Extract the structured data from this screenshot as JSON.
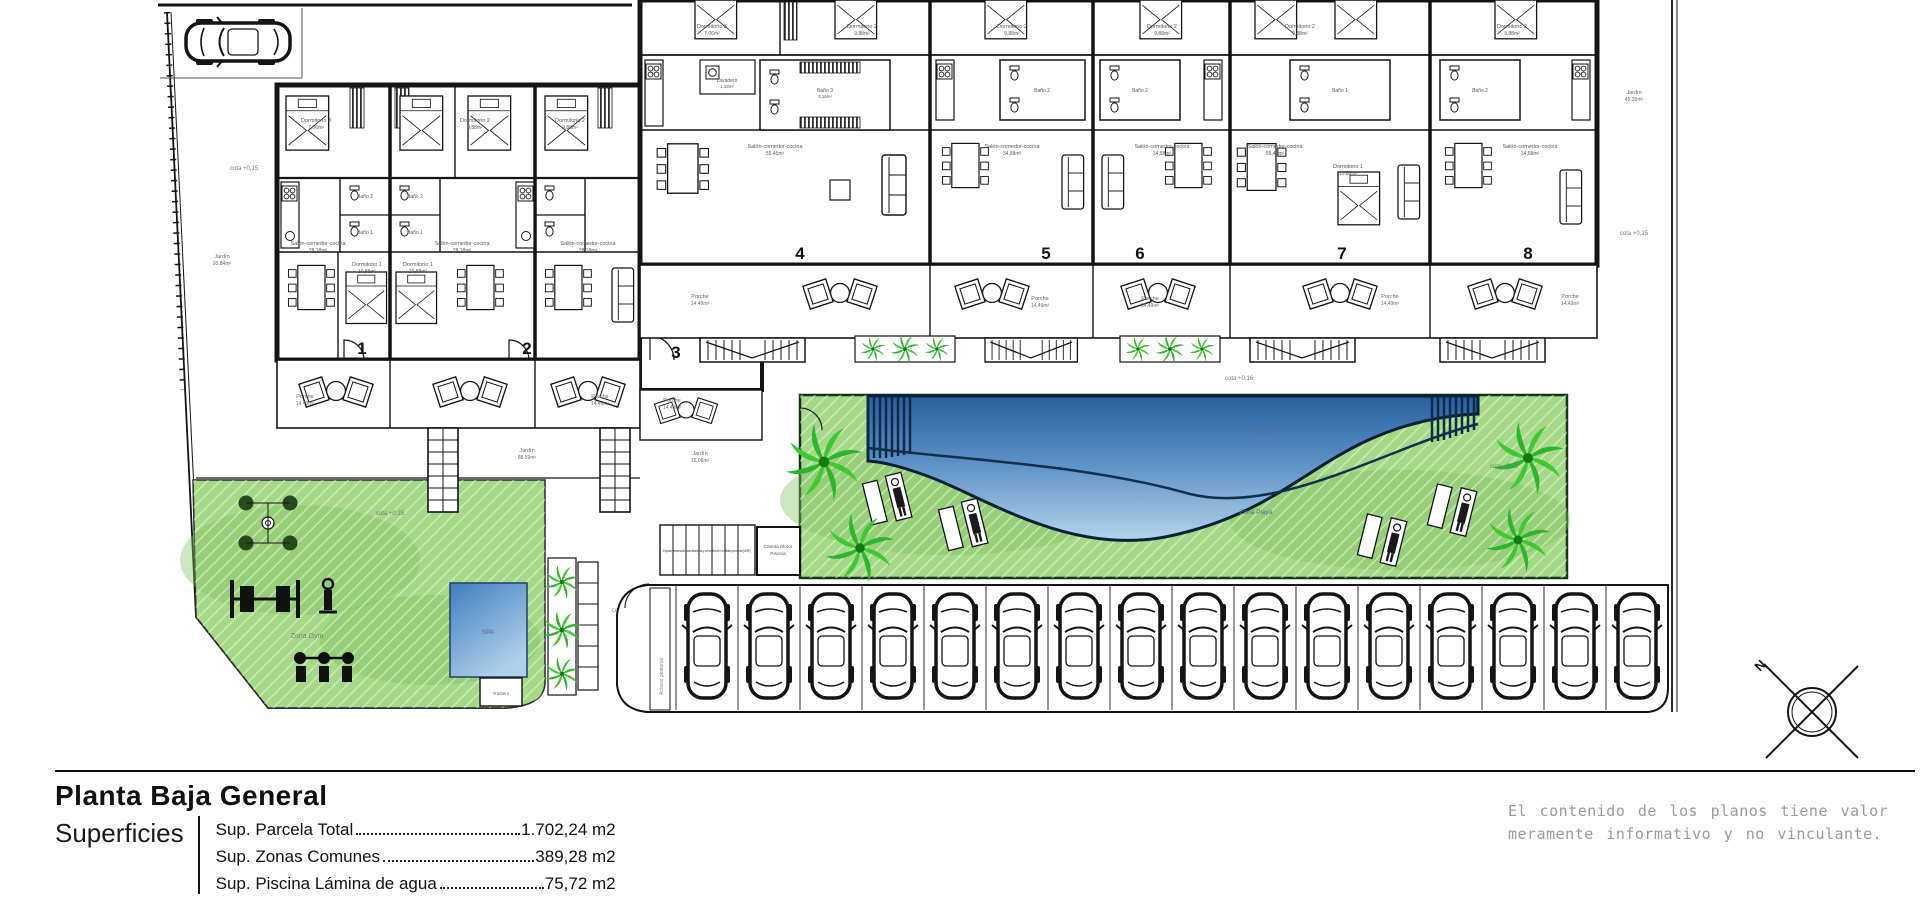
{
  "tb": {
    "title": "Planta Baja General",
    "sup_label": "Superficies",
    "rows": [
      {
        "label": "Sup. Parcela Total",
        "value": "1.702,24 m2"
      },
      {
        "label": "Sup. Zonas Comunes",
        "value": "389,28 m2"
      },
      {
        "label": "Sup. Piscina Lámina de agua",
        "value": "75,72 m2"
      }
    ],
    "disc": [
      "El contenido de los planos tiene valor",
      "meramente informativo y no vinculante."
    ]
  },
  "units": [
    "1",
    "2",
    "3",
    "4",
    "5",
    "6",
    "7",
    "8"
  ],
  "rooms": {
    "d1": "Dormitorio 1",
    "d1a": "10,88m²",
    "d2": "Dormitorio 2",
    "d2a": "9,88m²",
    "d3": "Dormitorio 3",
    "d3a": "7,06m²",
    "b1": "Baño 1",
    "b1a": "3,64m²",
    "b2": "Baño 2",
    "b2a": "3,76m²",
    "b3": "Baño 3",
    "b3a": "3,16m²",
    "salon": "Salón-comedor-cocina",
    "salon_a1": "28,18m²",
    "salon_a2": "55,45m²",
    "salon_a3": "34,58m²",
    "lav": "Lavadero",
    "lava": "1,43m²",
    "porche": "Porche",
    "porchea": "14,49m²",
    "jardin": "Jardín",
    "ja1": "93,84m²",
    "ja2": "88,59m²",
    "ja3": "15,06m²",
    "ja4": "45,26m²"
  },
  "site": {
    "cota15": "cota +0,15",
    "cota16": "cota +0,16",
    "piscina": "Piscina",
    "zona_playa": "Zona Playa",
    "zona_gym": "Zona Gym",
    "spa": "SPA",
    "caseta1": "Caseta Motor",
    "caseta2": "Piscina",
    "trastero": "Trastero",
    "north": "N",
    "bike": "Espacio reservado para bicicletas y vehículos de movilidad personal (VMP)",
    "acceso": "Acceso peatonal"
  },
  "colors": {
    "lawn": "#a5d887",
    "lawn_dark": "#7fc35e",
    "palm": "#2db52d",
    "pool_dark": "#2a5e9e",
    "pool_light": "#b3d4ec",
    "line": "#141414",
    "gray_text": "#8a8a8a"
  }
}
